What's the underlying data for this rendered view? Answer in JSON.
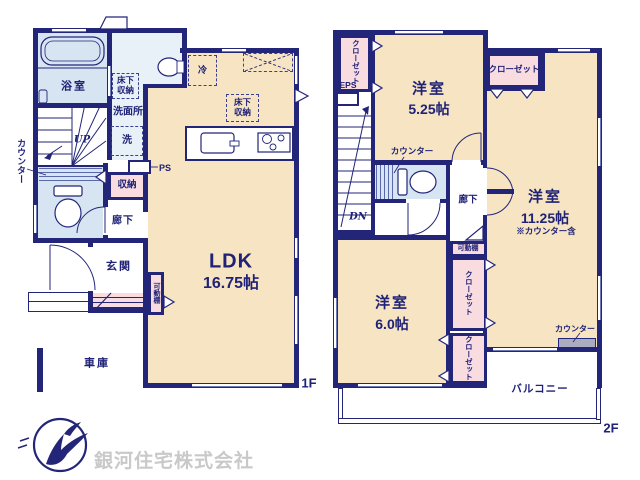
{
  "floor1": {
    "floor_label": "1F",
    "bath": "浴室",
    "underfloor_storage": "床下収納",
    "washroom": "洗面所",
    "washer": "洗",
    "stairs_up": "UP",
    "counter_side": "カウンター",
    "ps": "PS",
    "storage": "収納",
    "hallway": "廊下",
    "entrance": "玄関",
    "movable_shelf": "可動棚",
    "garage": "車庫",
    "fridge": "冷",
    "underfloor_storage_kitchen": "床下収納",
    "ldk_name": "LDK",
    "ldk_size": "16.75帖"
  },
  "floor2": {
    "floor_label": "2F",
    "closet_nw": "クローゼット",
    "eps": "EPS",
    "room_a_name": "洋室",
    "room_a_size": "5.25帖",
    "closet_n": "クローゼット",
    "counter_toilet": "カウンター",
    "stairs_dn": "DN",
    "hallway": "廊下",
    "room_b_name": "洋室",
    "room_b_size": "11.25帖",
    "room_b_note": "※カウンター含",
    "movable_shelf": "可動棚",
    "closet_e_upper": "クローゼット",
    "closet_e_lower": "クローゼット",
    "counter_balcony": "カウンター",
    "room_c_name": "洋室",
    "room_c_size": "6.0帖",
    "balcony": "バルコニー"
  },
  "logo": {
    "company_name": "銀河住宅株式会社"
  },
  "colors": {
    "wall_navy": "#232579",
    "room_cream": "#f6e4c3",
    "closet_pink": "#f8dce0",
    "wet_area_blue": "#d7e5f2",
    "counter_gray": "#a9adbf",
    "logo_text_gray": "#c9c9c9"
  }
}
